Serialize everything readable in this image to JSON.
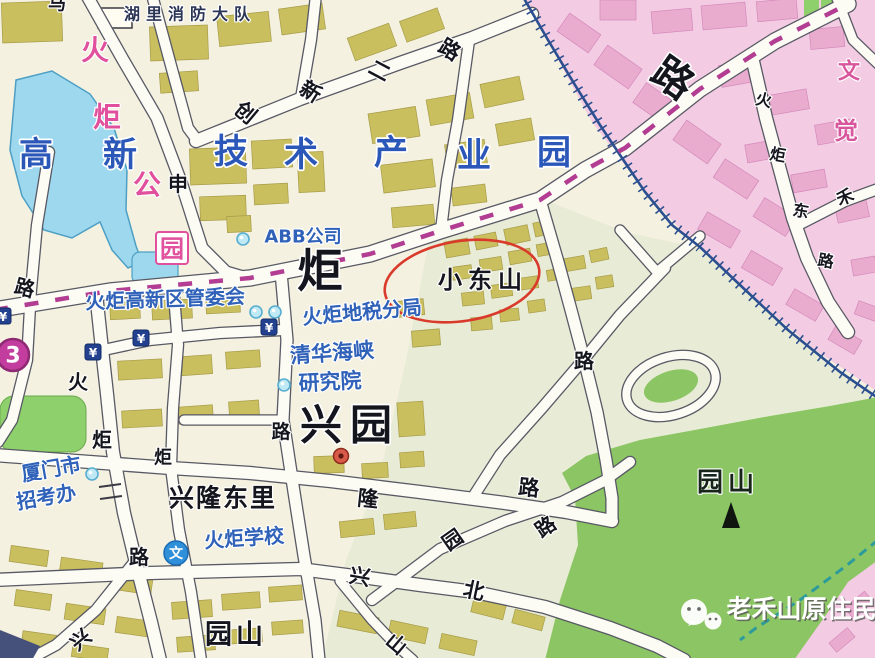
{
  "map": {
    "area_labels": [
      {
        "t": "湖里消防大队",
        "x": 190,
        "y": 13,
        "s": 16,
        "c": "#2b3556",
        "ls": 6,
        "w": 700
      },
      {
        "t": "高",
        "x": 36,
        "y": 154,
        "s": 34,
        "c": "#2b57b8",
        "w": 700
      },
      {
        "t": "新",
        "x": 120,
        "y": 154,
        "s": 34,
        "c": "#2b57b8",
        "w": 700
      },
      {
        "t": "技",
        "x": 231,
        "y": 151,
        "s": 34,
        "c": "#2b57b8",
        "w": 700
      },
      {
        "t": "术",
        "x": 301,
        "y": 154,
        "s": 34,
        "c": "#2b57b8",
        "w": 700
      },
      {
        "t": "产",
        "x": 391,
        "y": 152,
        "s": 34,
        "c": "#2b57b8",
        "w": 700
      },
      {
        "t": "业",
        "x": 474,
        "y": 155,
        "s": 34,
        "c": "#2b57b8",
        "w": 700
      },
      {
        "t": "园",
        "x": 554,
        "y": 152,
        "s": 34,
        "c": "#2b57b8",
        "w": 700
      },
      {
        "t": "火",
        "x": 95,
        "y": 49,
        "s": 28,
        "c": "#e0509c",
        "w": 700
      },
      {
        "t": "炬",
        "x": 107,
        "y": 116,
        "s": 28,
        "c": "#e0509c",
        "w": 700
      },
      {
        "t": "公",
        "x": 147,
        "y": 184,
        "s": 28,
        "c": "#e0509c",
        "w": 700
      },
      {
        "t": "园",
        "x": 172,
        "y": 248,
        "s": 24,
        "c": "#e0509c",
        "w": 700,
        "box": true
      },
      {
        "t": "文",
        "x": 849,
        "y": 71,
        "s": 22,
        "c": "#d8569c",
        "w": 700
      },
      {
        "t": "觉",
        "x": 846,
        "y": 130,
        "s": 24,
        "c": "#d8569c",
        "w": 700
      },
      {
        "t": "ABB公司",
        "x": 303,
        "y": 236,
        "s": 18,
        "c": "#2f62b8",
        "w": 600
      },
      {
        "t": "火炬高新区管委会",
        "x": 165,
        "y": 298,
        "s": 20,
        "c": "#2f62b8",
        "r": -2,
        "w": 600
      },
      {
        "t": "火炬地税分局",
        "x": 362,
        "y": 311,
        "s": 20,
        "c": "#2f62b8",
        "r": -5,
        "w": 600
      },
      {
        "t": "清华海峡",
        "x": 332,
        "y": 352,
        "s": 21,
        "c": "#2f62b8",
        "r": -4,
        "w": 600
      },
      {
        "t": "研究院",
        "x": 330,
        "y": 381,
        "s": 21,
        "c": "#2f62b8",
        "r": -3,
        "w": 600
      },
      {
        "t": "厦门市",
        "x": 51,
        "y": 468,
        "s": 20,
        "c": "#2f62b8",
        "r": -10,
        "w": 600
      },
      {
        "t": "招考办",
        "x": 46,
        "y": 496,
        "s": 20,
        "c": "#2f62b8",
        "r": -10,
        "w": 600
      },
      {
        "t": "火炬学校",
        "x": 244,
        "y": 537,
        "s": 20,
        "c": "#2f62b8",
        "r": -4,
        "w": 600
      },
      {
        "t": "小东山",
        "x": 483,
        "y": 279,
        "s": 24,
        "c": "#15151e",
        "ls": 6,
        "w": 700
      },
      {
        "t": "兴园",
        "x": 350,
        "y": 424,
        "s": 42,
        "c": "#15151e",
        "ls": 8,
        "w": 700
      },
      {
        "t": "兴隆东里",
        "x": 223,
        "y": 497,
        "s": 25,
        "c": "#15151e",
        "ls": 2,
        "w": 700
      },
      {
        "t": "园山",
        "x": 236,
        "y": 634,
        "s": 27,
        "c": "#15151e",
        "ls": 4,
        "w": 700
      },
      {
        "t": "园山",
        "x": 728,
        "y": 482,
        "s": 26,
        "c": "#16241a",
        "ls": 5,
        "w": 700
      }
    ],
    "road_glyphs": [
      {
        "t": "马",
        "x": 57,
        "y": 3,
        "s": 18
      },
      {
        "t": "创",
        "x": 246,
        "y": 112,
        "s": 21,
        "r": 40
      },
      {
        "t": "新",
        "x": 311,
        "y": 91,
        "s": 21,
        "r": 32
      },
      {
        "t": "二",
        "x": 380,
        "y": 70,
        "s": 21,
        "r": 28
      },
      {
        "t": "路",
        "x": 450,
        "y": 49,
        "s": 21,
        "r": 32
      },
      {
        "t": "申",
        "x": 178,
        "y": 183,
        "s": 20
      },
      {
        "t": "炬",
        "x": 320,
        "y": 270,
        "s": 46
      },
      {
        "t": "路",
        "x": 673,
        "y": 78,
        "s": 40,
        "r": 35
      },
      {
        "t": "火",
        "x": 78,
        "y": 381,
        "s": 20
      },
      {
        "t": "炬",
        "x": 102,
        "y": 439,
        "s": 20
      },
      {
        "t": "路",
        "x": 139,
        "y": 556,
        "s": 20
      },
      {
        "t": "炬",
        "x": 163,
        "y": 457,
        "s": 18
      },
      {
        "t": "路",
        "x": 25,
        "y": 287,
        "s": 20,
        "r": 15
      },
      {
        "t": "路",
        "x": 281,
        "y": 431,
        "s": 19
      },
      {
        "t": "路",
        "x": 584,
        "y": 360,
        "s": 20
      },
      {
        "t": "隆",
        "x": 368,
        "y": 498,
        "s": 21,
        "r": 6
      },
      {
        "t": "路",
        "x": 529,
        "y": 487,
        "s": 21,
        "r": 6
      },
      {
        "t": "园",
        "x": 452,
        "y": 539,
        "s": 20,
        "r": -35
      },
      {
        "t": "路",
        "x": 545,
        "y": 526,
        "s": 20,
        "r": -35
      },
      {
        "t": "兴",
        "x": 360,
        "y": 576,
        "s": 21,
        "r": 10
      },
      {
        "t": "北",
        "x": 474,
        "y": 590,
        "s": 21,
        "r": 12
      },
      {
        "t": "山",
        "x": 397,
        "y": 643,
        "s": 20,
        "r": 40
      },
      {
        "t": "兴",
        "x": 80,
        "y": 639,
        "s": 20,
        "r": -40
      },
      {
        "t": "火",
        "x": 764,
        "y": 99,
        "s": 16,
        "r": 12
      },
      {
        "t": "炬",
        "x": 778,
        "y": 154,
        "s": 16,
        "r": 10
      },
      {
        "t": "东",
        "x": 801,
        "y": 210,
        "s": 16,
        "r": 10
      },
      {
        "t": "路",
        "x": 826,
        "y": 260,
        "s": 16,
        "r": 10
      },
      {
        "t": "禾",
        "x": 845,
        "y": 197,
        "s": 17,
        "r": -22
      }
    ],
    "poi_icons": {
      "dots": [
        [
          243,
          239
        ],
        [
          256,
          312
        ],
        [
          275,
          312
        ],
        [
          284,
          385
        ],
        [
          92,
          474
        ]
      ],
      "banks": [
        [
          93,
          352
        ],
        [
          141,
          338
        ],
        [
          269,
          327
        ],
        [
          3,
          316
        ]
      ],
      "bank_symbol": "¥",
      "school": {
        "x": 176,
        "y": 553,
        "glyph": "文"
      },
      "route_badge": {
        "x": 13,
        "y": 355,
        "text": "3"
      },
      "summit": {
        "x": 731,
        "y": 516
      },
      "red_dot": {
        "x": 341,
        "y": 456
      }
    },
    "annotations": {
      "red_ellipse": {
        "cx": 462,
        "cy": 281,
        "rx": 78,
        "ry": 40,
        "rot": -9,
        "color": "#d93a2b"
      }
    },
    "colors": {
      "paper": "#f4f1e0",
      "sage": "#e8ecd6",
      "pink_zone": "#f3cbe3",
      "lake": "#9ed8ef",
      "hill": "#8cc564",
      "park": "#8ed06c",
      "building": "#c9bf5f",
      "pink_building": "#e9accf",
      "road_fill": "#fcfcf5",
      "road_casing": "#585964",
      "railway": "#2c4f8f",
      "boundary": "#b23d92",
      "stream": "#2e9b9b"
    }
  },
  "watermark": {
    "text": "老禾山原住民",
    "logo": "wechat-logo"
  }
}
